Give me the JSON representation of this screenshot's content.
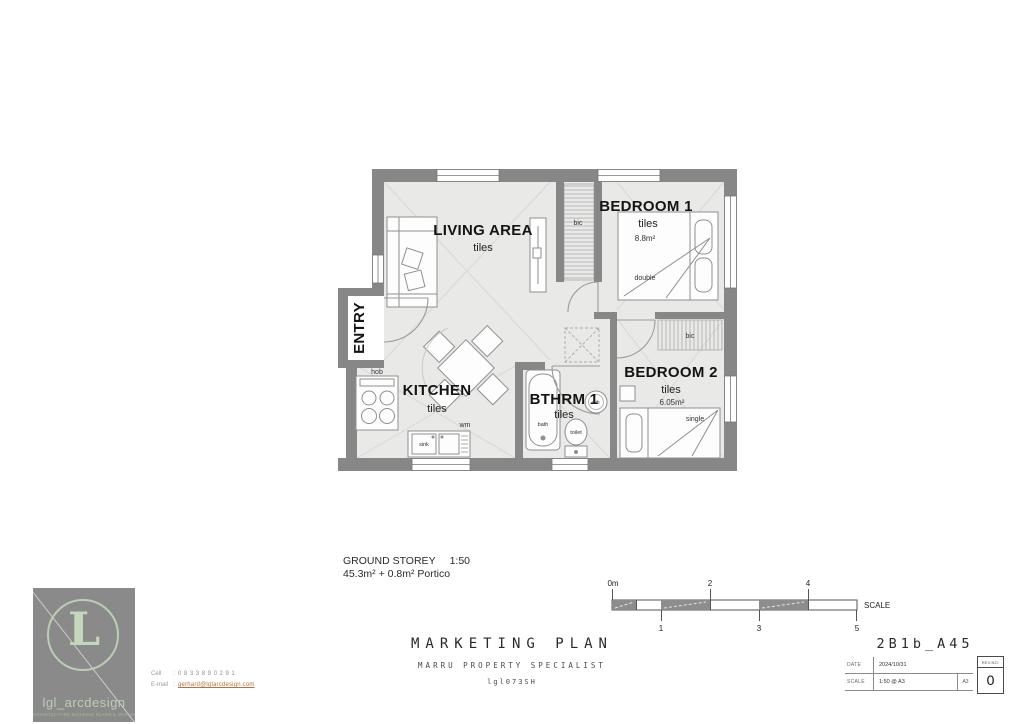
{
  "plan": {
    "rooms": {
      "living": {
        "name": "LIVING AREA",
        "floor": "tiles"
      },
      "bedroom1": {
        "name": "BEDROOM 1",
        "floor": "tiles",
        "area": "8.8m²",
        "bed": "double",
        "closet": "bic"
      },
      "bedroom2": {
        "name": "BEDROOM 2",
        "floor": "tiles",
        "area": "6.05m²",
        "bed": "single",
        "closet": "bic"
      },
      "kitchen": {
        "name": "KITCHEN",
        "floor": "tiles",
        "hob": "hob",
        "sink": "sink",
        "wm": "wm"
      },
      "bathroom": {
        "name": "BTHRM 1",
        "floor": "tiles",
        "bath": "bath",
        "toilet": "toilet",
        "wb": "wb"
      },
      "entry": {
        "name": "ENTRY"
      }
    },
    "caption": {
      "storey": "GROUND STOREY",
      "scale": "1:50",
      "areas": "45.3m² + 0.8m² Portico"
    }
  },
  "scalebar": {
    "ticks_top": [
      "0m",
      "2",
      "4"
    ],
    "ticks_bottom": [
      "1",
      "3",
      "5"
    ],
    "label": "SCALE"
  },
  "titleblock": {
    "title": "MARKETING PLAN",
    "subtitle": "MARRU PROPERTY SPECIALIST",
    "code": "lgl073SH"
  },
  "sheet": {
    "number": "2B1b_A45",
    "date_label": "DATE",
    "date": "2024/10/31",
    "scale_label": "SCALE",
    "scale": "1:50 @ A3",
    "paper": "A3",
    "rev_label": "REV.NO.",
    "rev": "0"
  },
  "brand": {
    "monogram": "L",
    "name": "lgl_arcdesign",
    "tagline": "ARCHITECTURE BUILDING PLANS & DESIGN",
    "cell_label": "Cell",
    "cell": "0833890291",
    "email_label": "E-mail",
    "email": "gerhard@lglarcdesign.com"
  },
  "colors": {
    "wall": "#878787",
    "floor": "#e9e9e7",
    "logo_bg": "#8a8a8a",
    "logo_accent": "#b9cfb2",
    "email_link": "#b5703f"
  }
}
